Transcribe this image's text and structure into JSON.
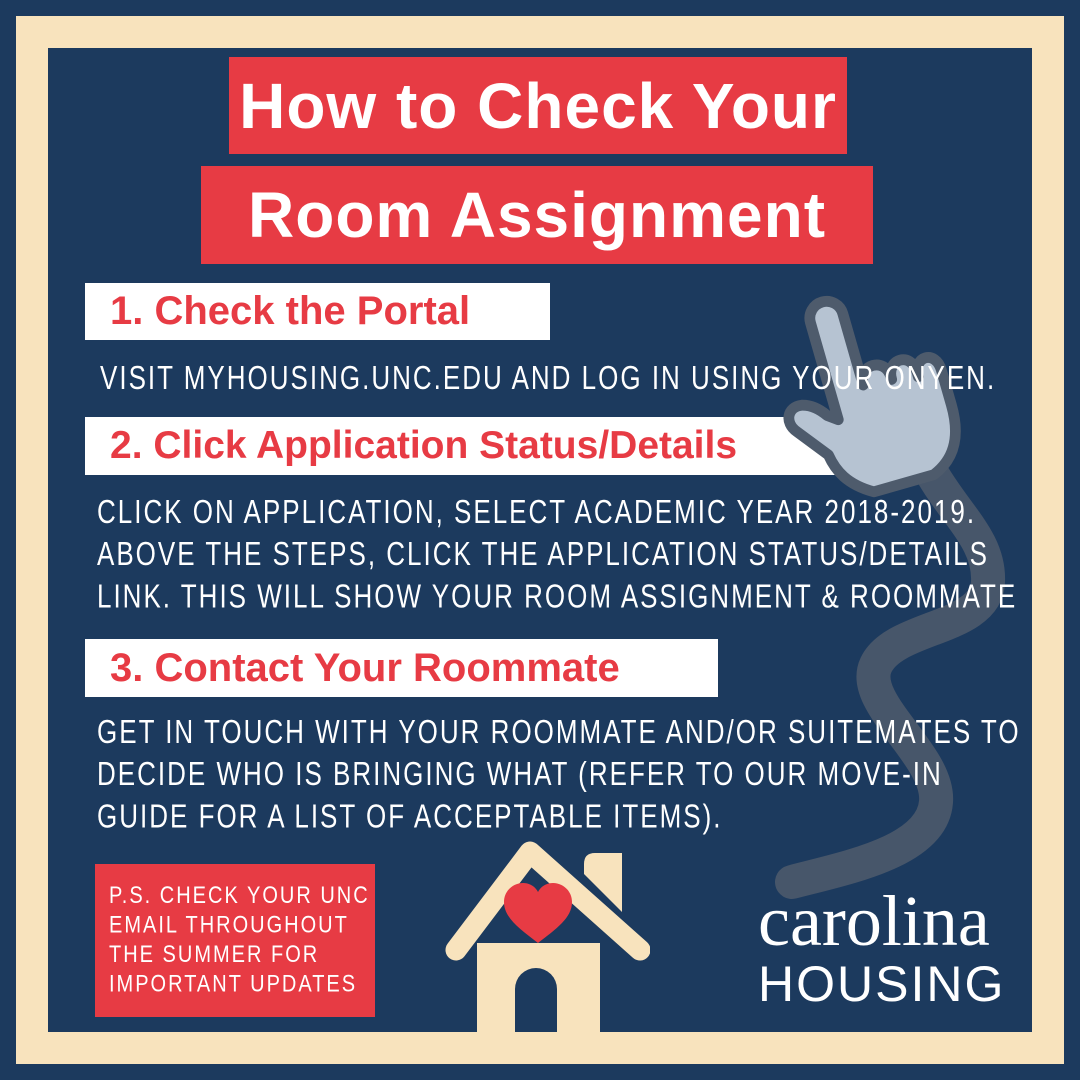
{
  "poster": {
    "title_line1": "How to Check Your",
    "title_line2": "Room Assignment",
    "steps": [
      {
        "heading": "1. Check the Portal",
        "body": "VISIT MYHOUSING.UNC.EDU AND LOG IN USING YOUR ONYEN."
      },
      {
        "heading": "2. Click Application Status/Details",
        "body": "CLICK ON APPLICATION, SELECT ACADEMIC YEAR 2018-2019.\nABOVE THE STEPS, CLICK THE APPLICATION STATUS/DETAILS\nLINK. THIS WILL SHOW YOUR ROOM ASSIGNMENT & ROOMMATE"
      },
      {
        "heading": "3. Contact Your Roommate",
        "body": "GET IN TOUCH WITH YOUR ROOMMATE AND/OR SUITEMATES TO\nDECIDE WHO IS BRINGING WHAT (REFER TO OUR MOVE-IN\nGUIDE FOR A LIST OF ACCEPTABLE ITEMS)."
      }
    ],
    "ps_note": "P.S. CHECK YOUR UNC\nEMAIL THROUGHOUT\nTHE SUMMER FOR\nIMPORTANT UPDATES",
    "logo": {
      "line1": "carolina",
      "line2": "HOUSING"
    },
    "icons": {
      "house": "house-with-heart-icon",
      "cursor": "hand-cursor-icon"
    },
    "colors": {
      "navy": "#1c3a5e",
      "cream": "#f8e3bd",
      "red": "#e73b44",
      "white": "#ffffff",
      "hand-fill": "#b6c3d2",
      "hand-outline": "#4e5b6c",
      "cord": "#47566a"
    }
  }
}
